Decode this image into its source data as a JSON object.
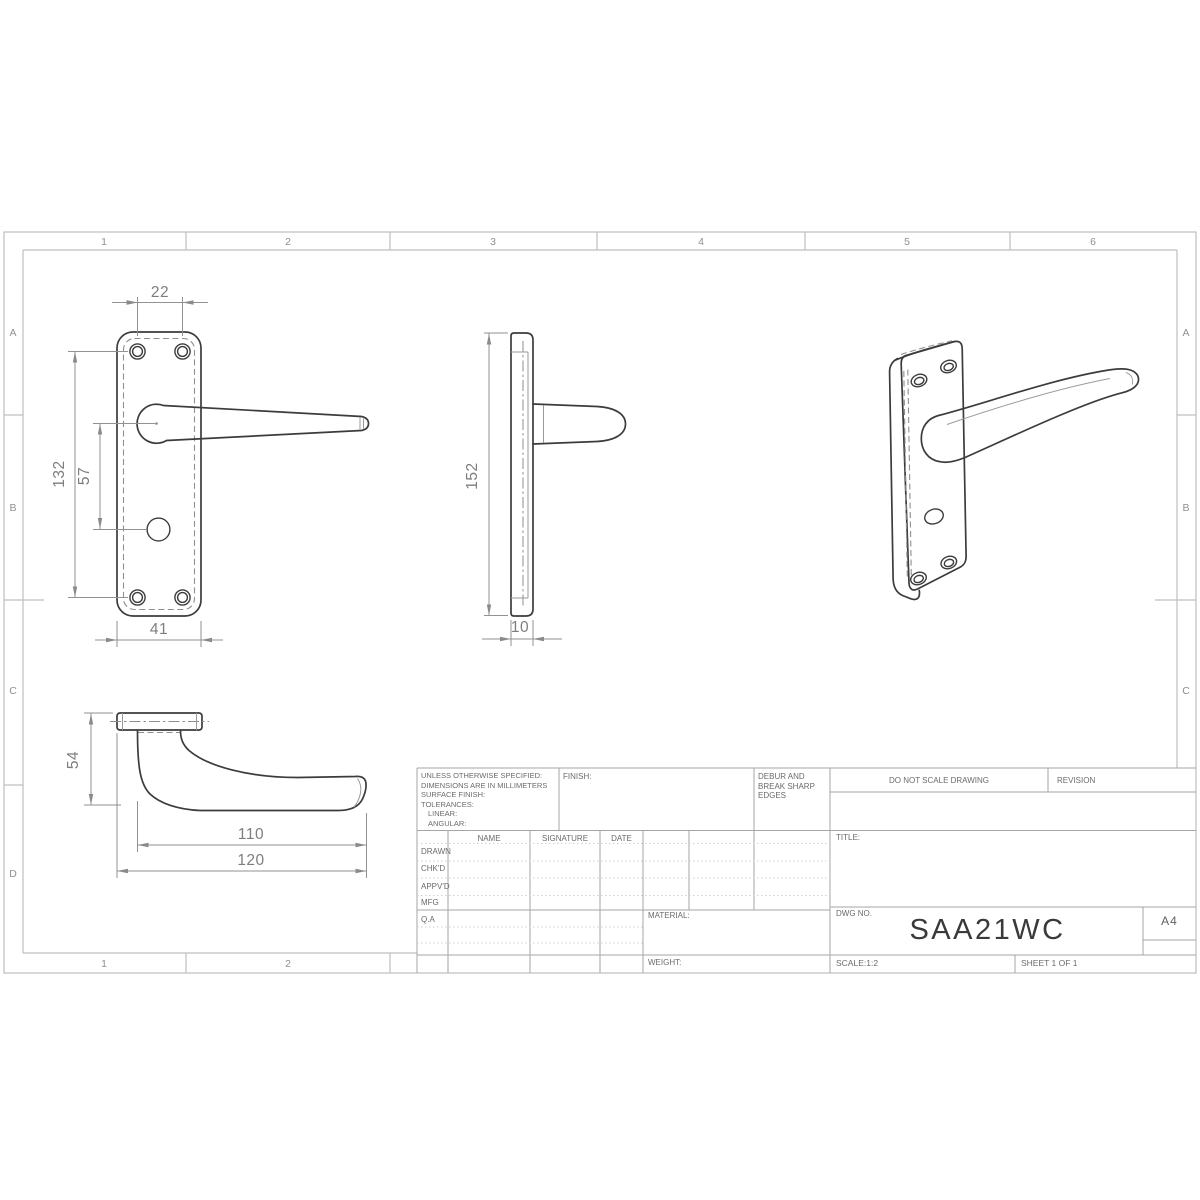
{
  "frame": {
    "top_columns": [
      "1",
      "2",
      "3",
      "4",
      "5",
      "6"
    ],
    "bottom_columns": [
      "1",
      "2"
    ],
    "left_rows": [
      "A",
      "B",
      "C",
      "D"
    ],
    "right_rows": [
      "A",
      "B",
      "C"
    ]
  },
  "dimensions": {
    "front": {
      "hole_spacing": "22",
      "plate_hole_height": "132",
      "lever_to_spindle": "57",
      "plate_width": "41"
    },
    "side": {
      "plate_height": "152",
      "plate_thickness": "10"
    },
    "lever": {
      "projection": "54",
      "grip_length": "110",
      "overall_length": "120"
    }
  },
  "title_block": {
    "spec_note_lines": [
      "UNLESS OTHERWISE SPECIFIED:",
      "DIMENSIONS ARE IN MILLIMETERS",
      "SURFACE FINISH:",
      "TOLERANCES:",
      "LINEAR:",
      "ANGULAR:"
    ],
    "finish_label": "FINISH:",
    "debur_note_lines": [
      "DEBUR AND",
      "BREAK SHARP",
      "EDGES"
    ],
    "do_not_scale": "DO NOT SCALE DRAWING",
    "revision_label": "REVISION",
    "approval_columns": {
      "name": "NAME",
      "signature": "SIGNATURE",
      "date": "DATE"
    },
    "approval_rows": [
      "DRAWN",
      "CHK'D",
      "APPV'D",
      "MFG",
      "Q.A"
    ],
    "material_label": "MATERIAL:",
    "weight_label": "WEIGHT:",
    "title_label": "TITLE:",
    "dwg_no_label": "DWG NO.",
    "dwg_no_value": "SAA21WC",
    "paper_size": "A4",
    "scale_text": "SCALE:1:2",
    "sheet_text": "SHEET 1 OF 1"
  },
  "colors": {
    "part_edge": "#3c3c3c",
    "dimension": "#8a8a8a",
    "frame_line": "#bfbfbf",
    "background": "#ffffff"
  }
}
